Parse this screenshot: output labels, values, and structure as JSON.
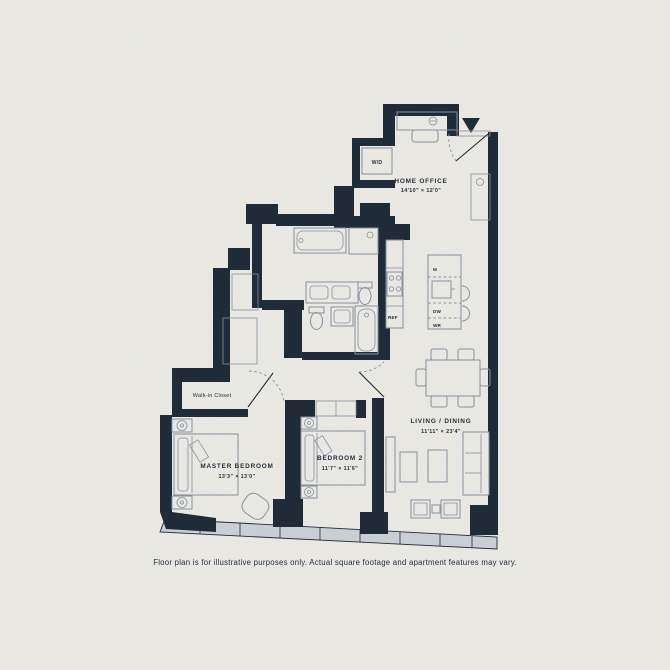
{
  "colors": {
    "background": "#edece7",
    "wall": "#1d2936",
    "line": "#8792a0",
    "window_fill": "#ccd2d7",
    "text": "#1d2936"
  },
  "caption": "Floor plan is for illustrative purposes only. Actual square footage and apartment features may vary.",
  "rooms": {
    "home_office": {
      "name": "HOME OFFICE",
      "dims": "14'10\" × 12'0\""
    },
    "living_dining": {
      "name": "LIVING / DINING",
      "dims": "11'11\" × 23'4\""
    },
    "master_bedroom": {
      "name": "MASTER BEDROOM",
      "dims": "13'3\" × 13'0\""
    },
    "bedroom_2": {
      "name": "BEDROOM 2",
      "dims": "11'7\" × 11'6\""
    },
    "walk_in_closet": {
      "name": "Walk-in Closet"
    }
  },
  "labels": {
    "washer_dryer": "W/D",
    "microwave": "M",
    "dishwasher": "DW",
    "wine_ref": "WR",
    "refrigerator": "REF"
  }
}
